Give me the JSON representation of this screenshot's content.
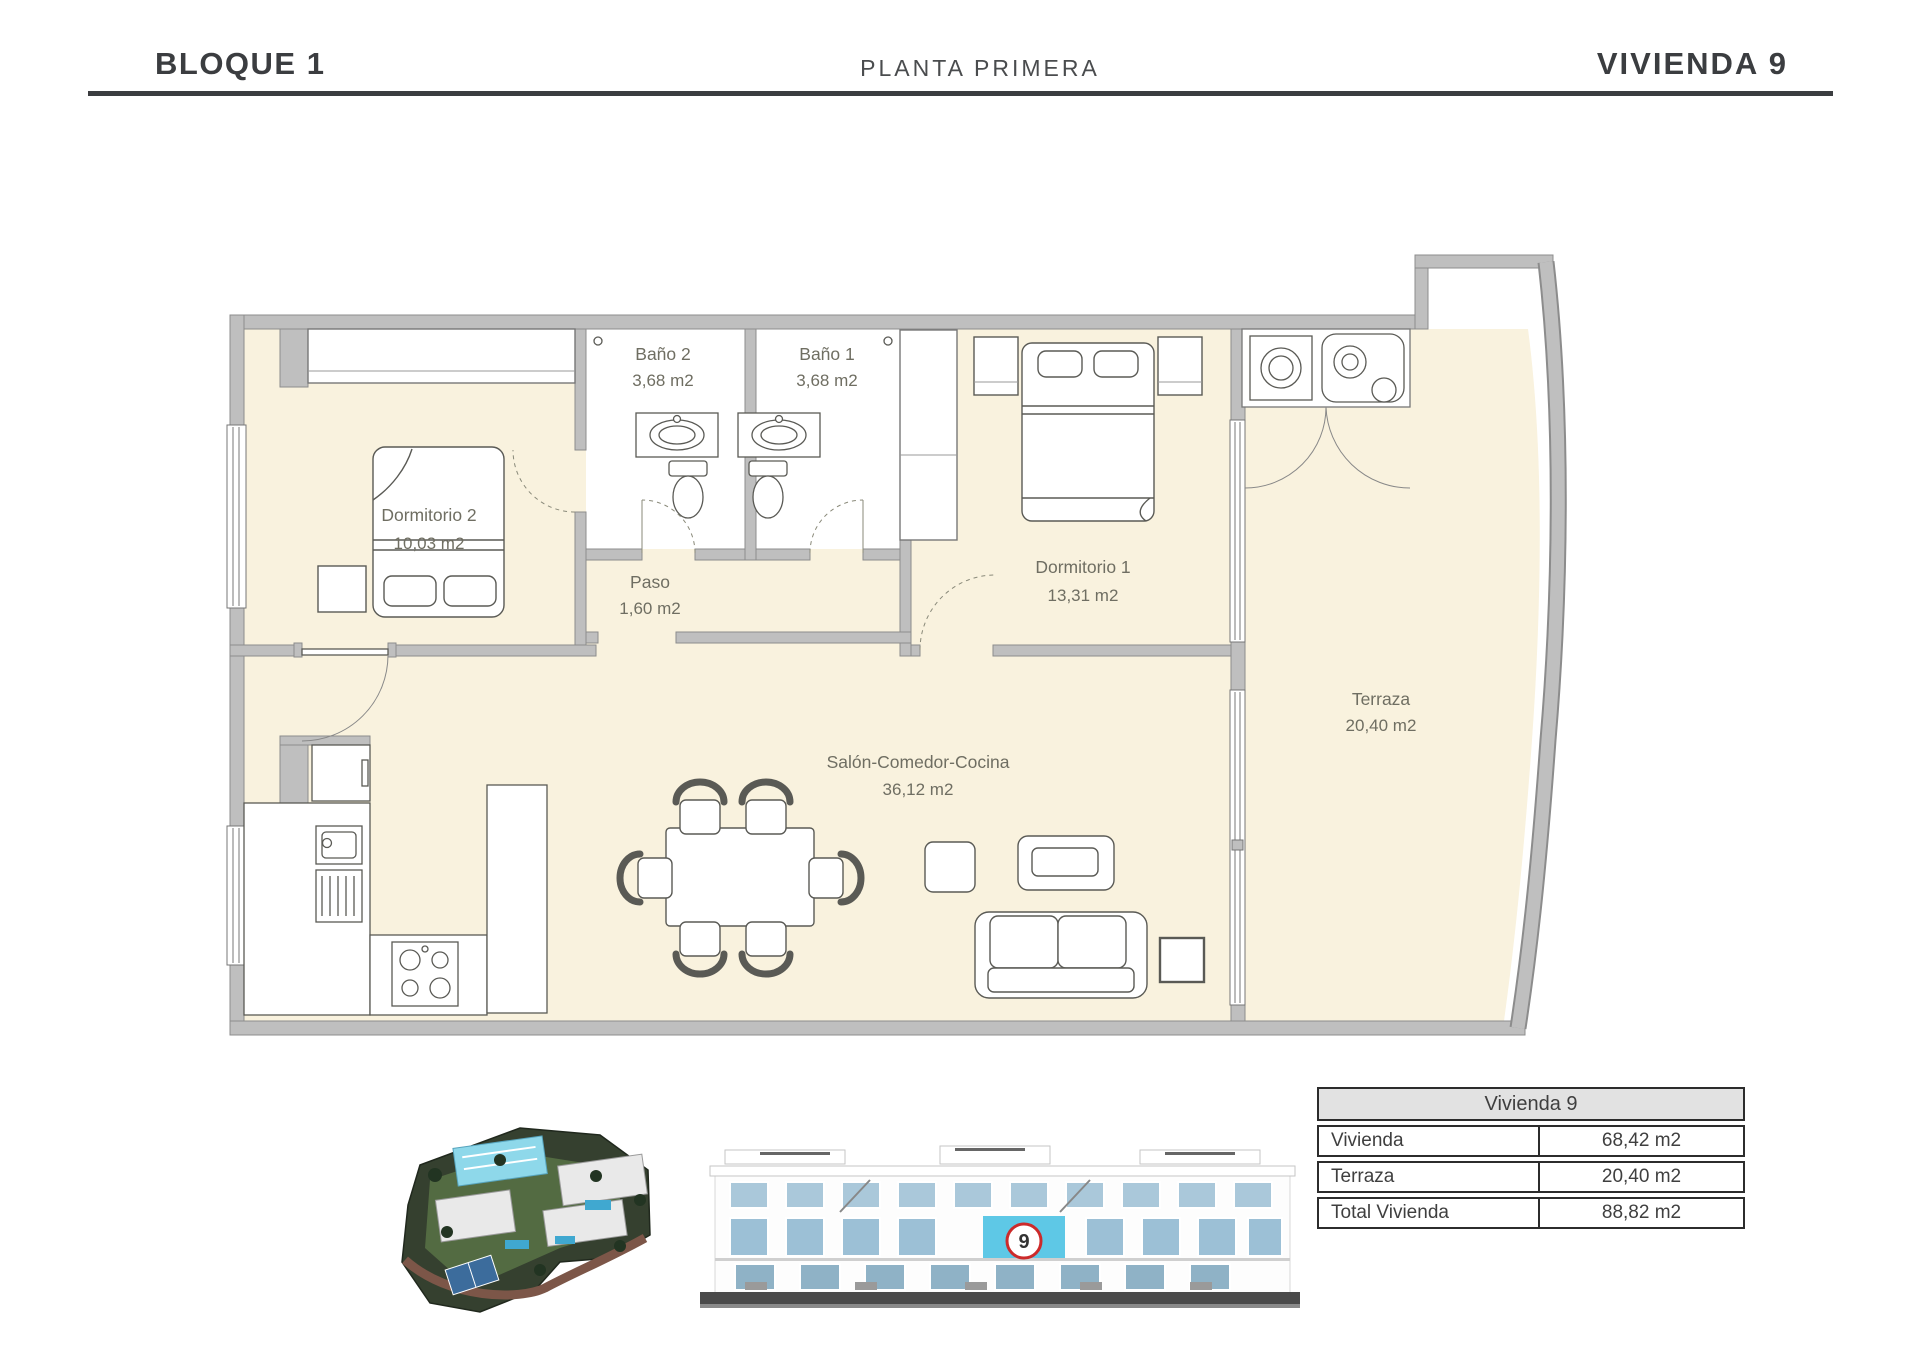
{
  "header": {
    "block": "BLOQUE 1",
    "plant": "PLANTA PRIMERA",
    "unit": "VIVIENDA 9"
  },
  "floorplan": {
    "rooms": {
      "dormitorio2": {
        "name": "Dormitorio 2",
        "area": "10,03 m2"
      },
      "bano2": {
        "name": "Baño 2",
        "area": "3,68 m2"
      },
      "bano1": {
        "name": "Baño 1",
        "area": "3,68 m2"
      },
      "paso": {
        "name": "Paso",
        "area": "1,60 m2"
      },
      "dormitorio1": {
        "name": "Dormitorio 1",
        "area": "13,31 m2"
      },
      "salon": {
        "name": "Salón-Comedor-Cocina",
        "area": "36,12 m2"
      },
      "terraza": {
        "name": "Terraza",
        "area": "20,40 m2"
      }
    }
  },
  "elevation": {
    "unit_number": "9"
  },
  "summary_table": {
    "title": "Vivienda 9",
    "rows": [
      {
        "label": "Vivienda",
        "value": "68,42 m2"
      },
      {
        "label": "Terraza",
        "value": "20,40 m2"
      },
      {
        "label": "Total Vivienda",
        "value": "88,82 m2"
      }
    ]
  },
  "colors": {
    "ink": "#3b3d40",
    "floor_cream": "#f9f2de",
    "wall_gray": "#bfbfbf",
    "label_gray": "#6f6e62",
    "highlight_cyan": "#5ec8e6",
    "accent_red": "#cc2a2a"
  }
}
